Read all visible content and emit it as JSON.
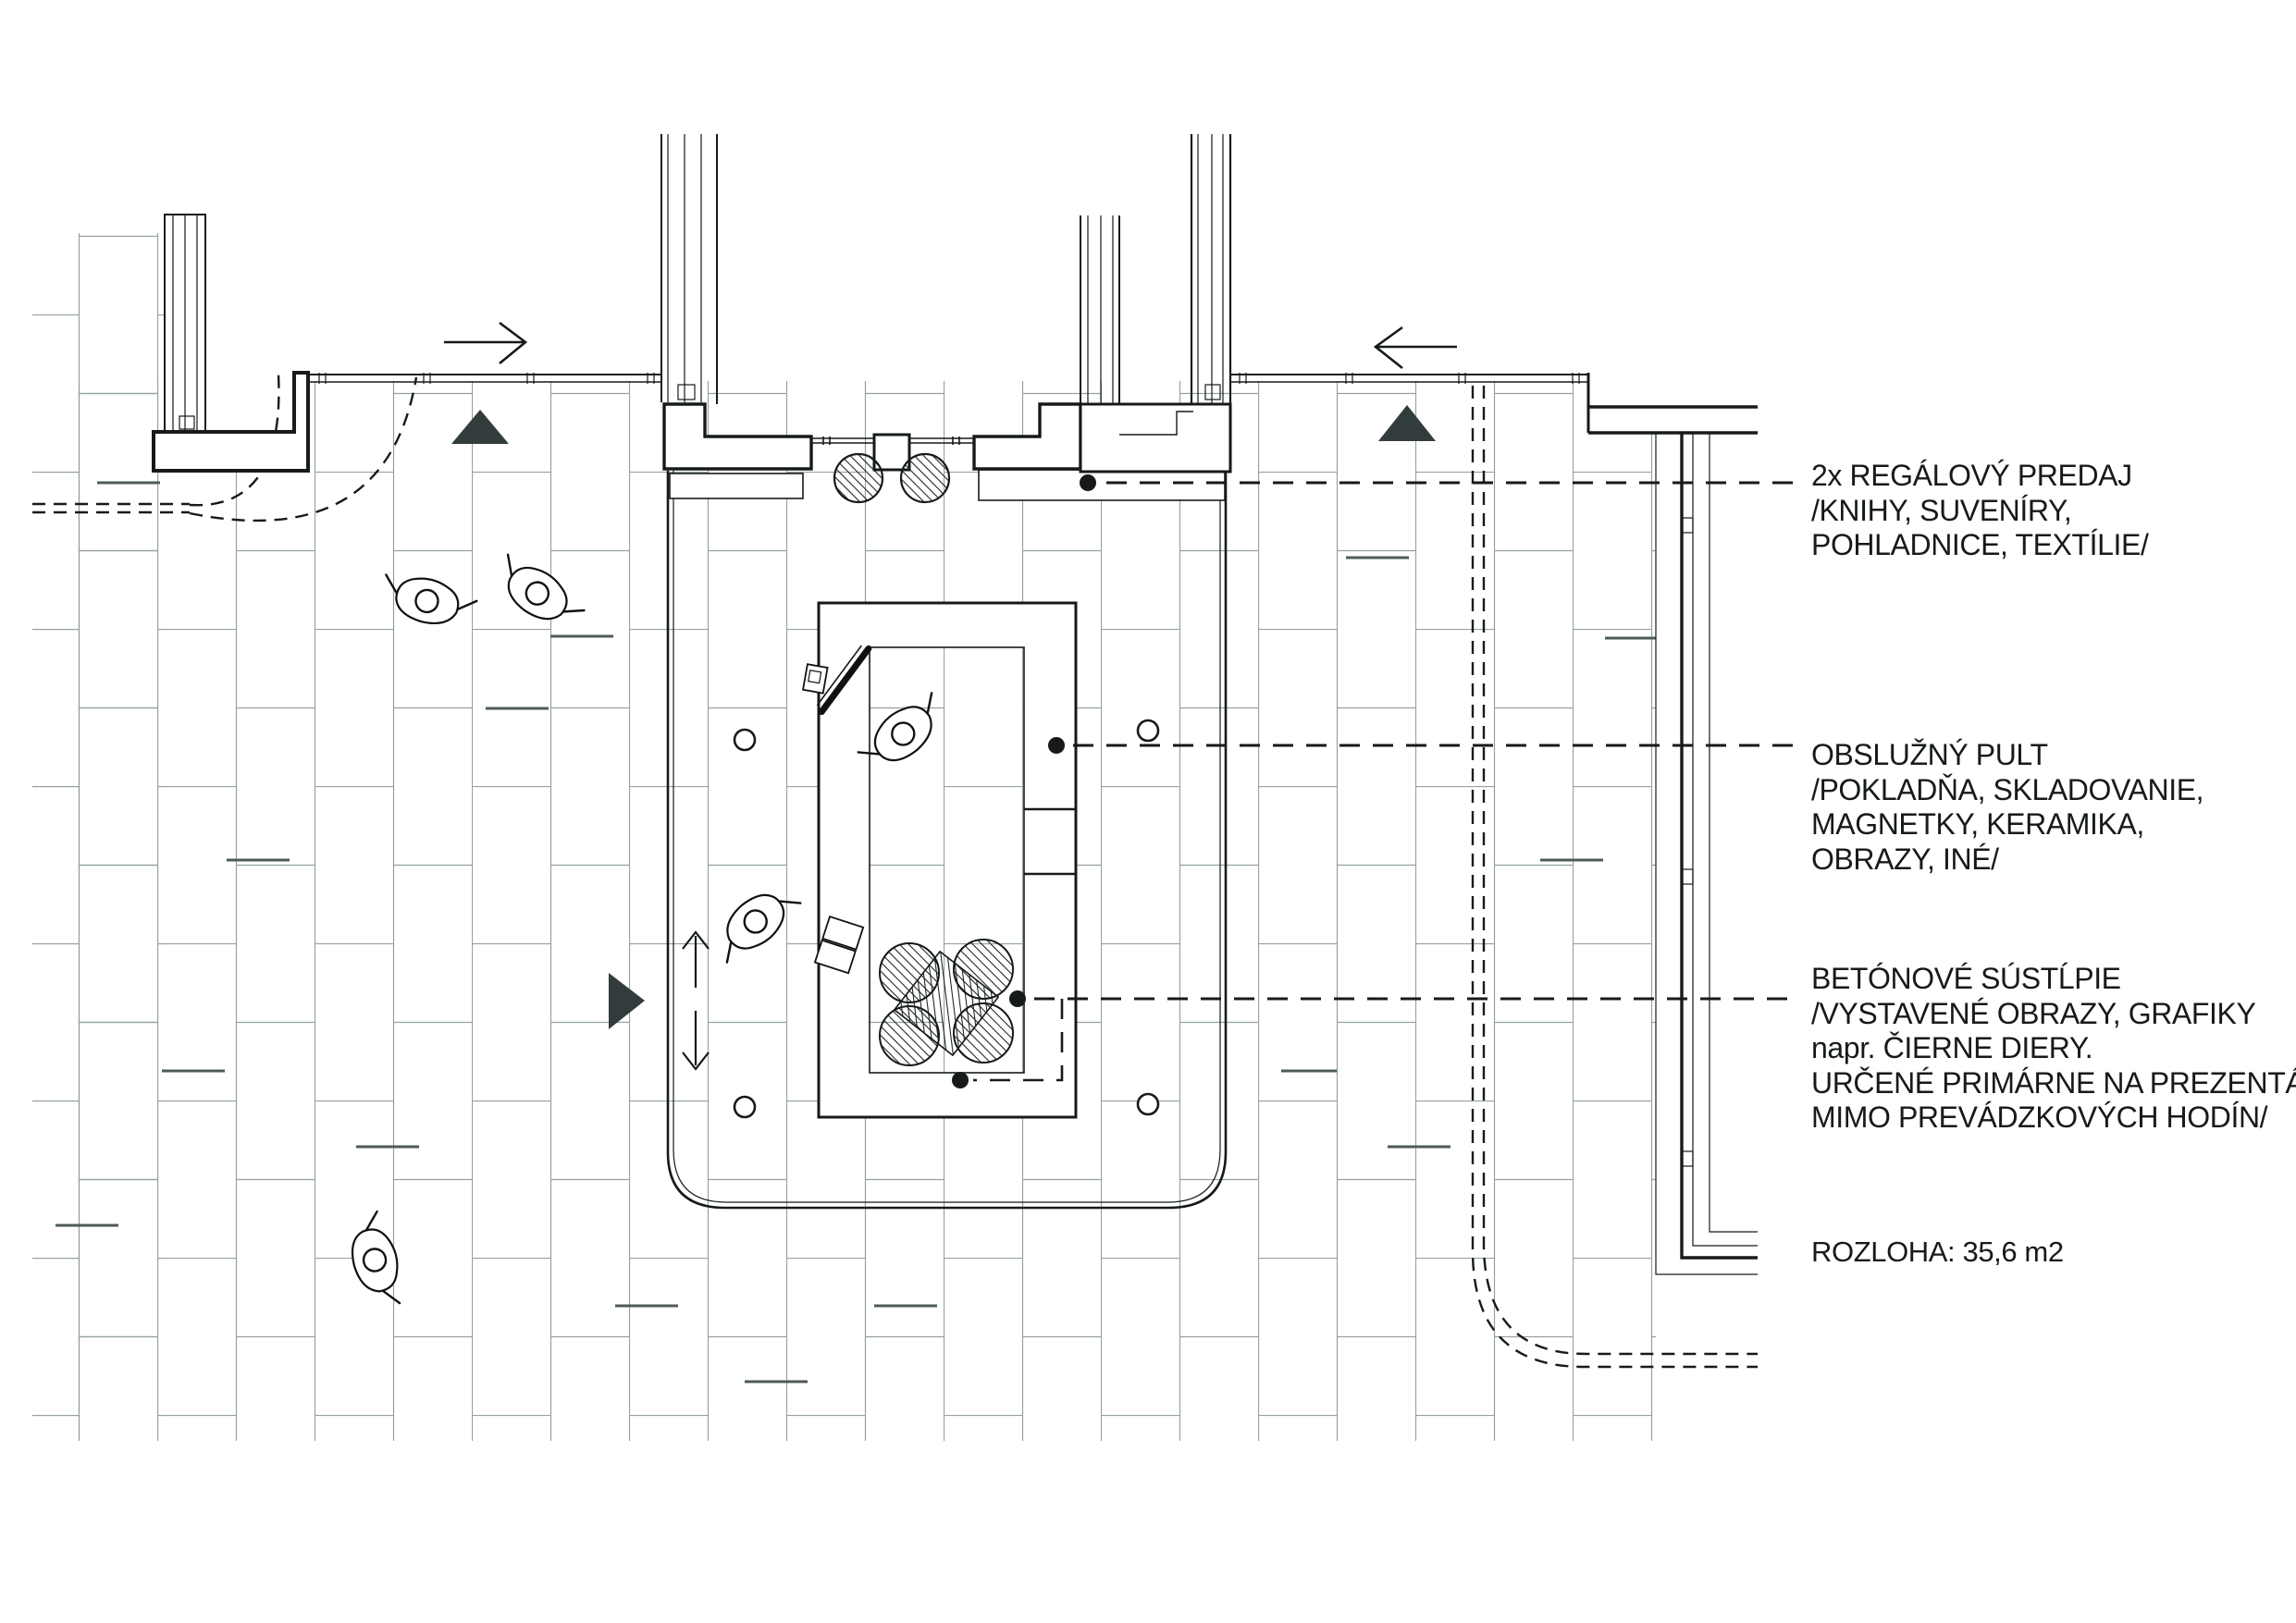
{
  "drawing": {
    "annotations": [
      {
        "id": "shelving",
        "lines": [
          "2x REGÁLOVÝ PREDAJ",
          "/KNIHY, SUVENÍRY,",
          "POHLADNICE, TEXTÍLIE/"
        ]
      },
      {
        "id": "counter",
        "lines": [
          "OBSLUŽNÝ PULT",
          "/POKLADŇA, SKLADOVANIE,",
          "MAGNETKY, KERAMIKA,",
          "OBRAZY, INÉ/"
        ]
      },
      {
        "id": "columns",
        "lines": [
          "BETÓNOVÉ SÚSTĹPIE",
          "/VYSTAVENÉ OBRAZY, GRAFIKY",
          "napr. ČIERNE DIERY.",
          "URČENÉ PRIMÁRNE NA PREZENTÁCIU",
          "MIMO PREVÁDZKOVÝCH HODÍN/"
        ]
      },
      {
        "id": "area",
        "lines": [
          "ROZLOHA: 35,6 m2"
        ]
      }
    ],
    "colors": {
      "ink": "#161a1a",
      "hatch": "#95a1a1",
      "hatch_dark": "#4e5a5a",
      "triangle": "#333c3c",
      "paper": "#ffffff"
    }
  }
}
